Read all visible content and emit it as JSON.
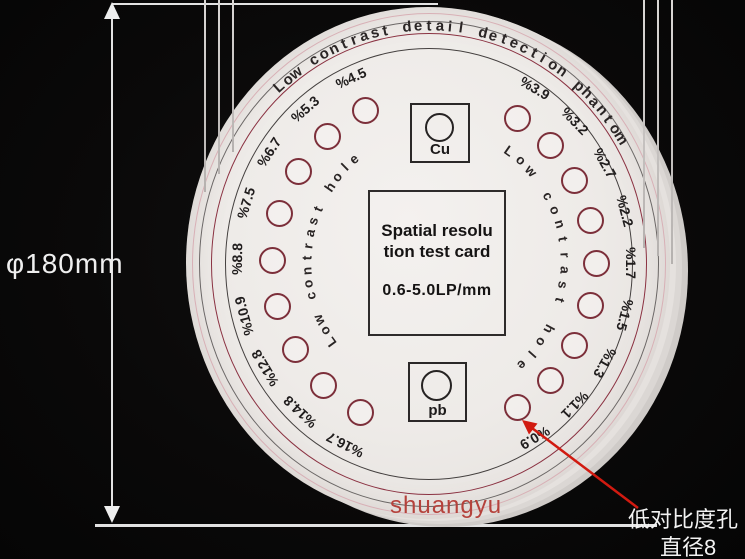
{
  "dimension": {
    "label": "φ180mm"
  },
  "disc": {
    "title_arc": "Low contrast detail detection phantom",
    "left_arc_label": "Low contrast hole",
    "right_arc_label": "Low contrast hole",
    "center_card": {
      "line1": "Spatial resolu",
      "line2": "tion test card",
      "line3": "0.6-5.0LP/mm"
    },
    "cu_marker": "Cu",
    "pb_marker": "pb",
    "left_hole_labels": [
      "%4.5",
      "%5.3",
      "%6.7",
      "%7.5",
      "%8.8",
      "%10.9",
      "%12.8",
      "%14.8",
      "%16.7"
    ],
    "right_hole_labels": [
      "%3.9",
      "%3.2",
      "%2.7",
      "%2.2",
      "%1.7",
      "%1.5",
      "%1.3",
      "%1.1",
      "%0.9"
    ]
  },
  "watermark": "shuangyu",
  "callout": {
    "line1": "低对比度孔",
    "line2": "直径8"
  },
  "colors": {
    "disc_fill": "#eeebe8",
    "pink_ring": "#d8b0b6",
    "gray_ring": "#6b6766",
    "maroon_ring": "#8b3242",
    "dark_ring": "#44403f",
    "hole_outline": "#7c2f3a",
    "arrow_red": "#d11a10",
    "watermark_red": "#b5423c"
  }
}
